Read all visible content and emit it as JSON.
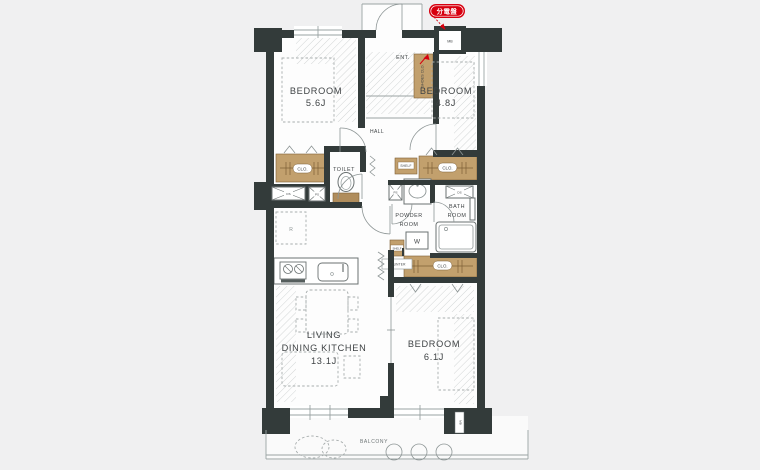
{
  "colors": {
    "background": "#f0f0f1",
    "wall": "#333b3a",
    "closet_tan": "#c2a06d",
    "accent_red": "#d7000f",
    "floor": "#fdfdfd"
  },
  "badge": {
    "label": "分電盤"
  },
  "entrance": {
    "label": "ENT.",
    "shoes_closet_label": "SHOES CLO.",
    "meter_box_label": "MB"
  },
  "hall": {
    "label": "HALL"
  },
  "rooms": {
    "bedroom1": {
      "name": "BEDROOM",
      "size": "5.6J"
    },
    "bedroom2": {
      "name": "BEDROOM",
      "size": "4.8J"
    },
    "bedroom3": {
      "name": "BEDROOM",
      "size": "6.1J"
    },
    "ldk": {
      "name_line1": "LIVING",
      "name_line2": "DINING KITCHEN",
      "size": "13.1J"
    },
    "toilet": {
      "label": "TOILET"
    },
    "powder_room": {
      "line1": "POWDER",
      "line2": "ROOM"
    },
    "bath_room": {
      "line1": "BATH",
      "line2": "ROOM"
    },
    "balcony": {
      "label": "BALCONY"
    }
  },
  "fixtures": {
    "closet_label": "CLO.",
    "shelf_label": "SHELF",
    "counter_label": "COUNTER",
    "washer_label": "W",
    "refrigerator_label": "R",
    "duct_space_label": "DS",
    "pipe_space_label": "PS",
    "balcony_meter_label": "MB"
  }
}
